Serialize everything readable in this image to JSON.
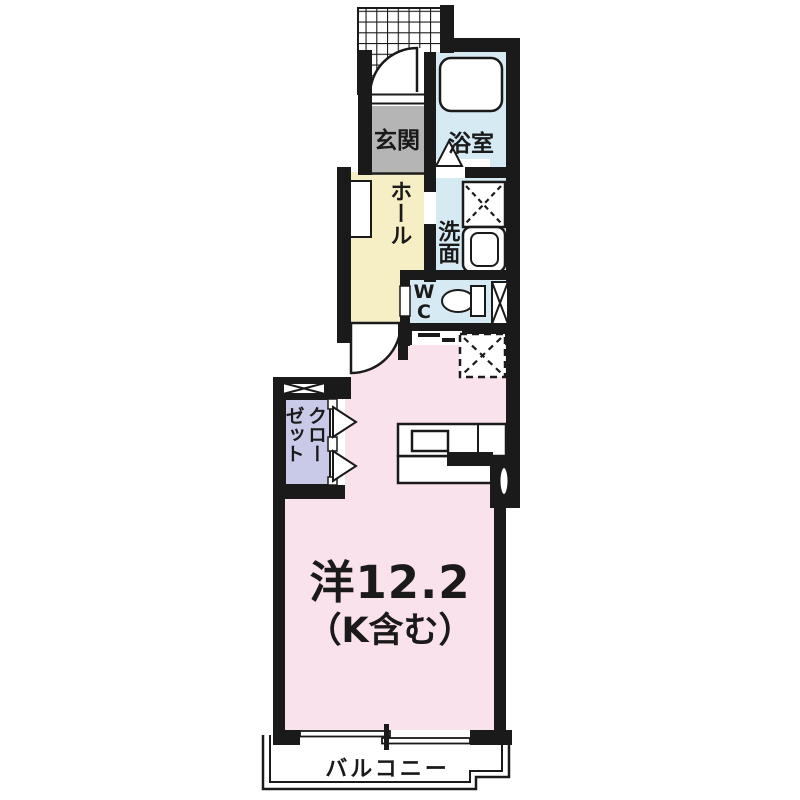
{
  "page": {
    "background": "#ffffff"
  },
  "colors": {
    "wall": "#1a1a1a",
    "entrance_floor": "#b5b5b5",
    "wet_area_floor": "#d6eaf3",
    "hall_floor": "#f6efc6",
    "closet_floor": "#c9c9e8",
    "main_room_floor": "#f9e2ec",
    "balcony_floor": "#ffffff",
    "line": "#1a1a1a"
  },
  "rooms": {
    "genkan": {
      "label": "玄関"
    },
    "bathroom": {
      "label": "浴室"
    },
    "hall": {
      "label": "ホール"
    },
    "washroom": {
      "label": "洗面"
    },
    "wc": {
      "label": "W\nC"
    },
    "closet": {
      "label": "クロー\nゼット"
    },
    "living": {
      "label": "洋12.2",
      "sublabel": "（K含む）"
    },
    "balcony": {
      "label": "バルコニー"
    }
  },
  "fixtures": [
    "entrance-porch-hatch",
    "entrance-door-swing",
    "bathtub",
    "bathroom-door-triangle",
    "shoe-cabinet",
    "washing-machine-space",
    "washbasin",
    "toilet",
    "refrigerator-space",
    "kitchen-counter-with-sink",
    "closet-folding-doors",
    "cross-window",
    "casement-window",
    "sliding-glass-door"
  ]
}
